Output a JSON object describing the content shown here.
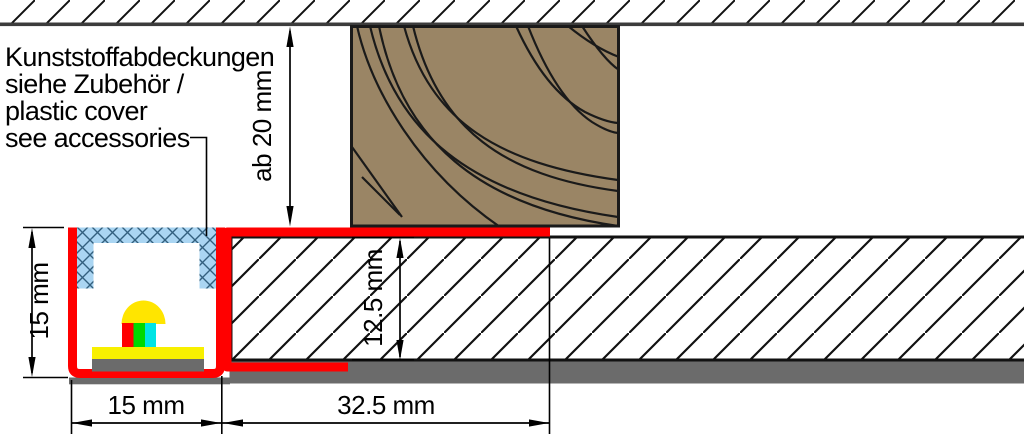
{
  "figure": {
    "title": "Recessed LED profile mounting cross-section",
    "annotation": {
      "line1": "Kunststoffabdeckungen",
      "line2": "siehe Zubehör /",
      "line3": "plastic cover",
      "line4": "see accessories"
    },
    "dimensions": {
      "recess_height": "ab 20 mm",
      "profile_height": "15 mm",
      "panel_thickness": "12.5 mm",
      "profile_width": "15 mm",
      "flange_width": "32.5 mm"
    },
    "colors": {
      "profile-red": "#ff0000",
      "wood-brown": "#9a8565",
      "cover-blue": "#aad5f2",
      "cover-hatch-blue": "#33607f",
      "plaster-gray": "#6b6b6b",
      "band-border-gray": "#3c3c3c",
      "outline-black": "#1a1a1a",
      "led-dome-yellow": "#ffe500",
      "pcb-yellow": "#f8f000",
      "chip-red": "#ff0000",
      "chip-green": "#00d900",
      "chip-cyan": "#00e4e4",
      "dim-black": "#000000"
    }
  }
}
